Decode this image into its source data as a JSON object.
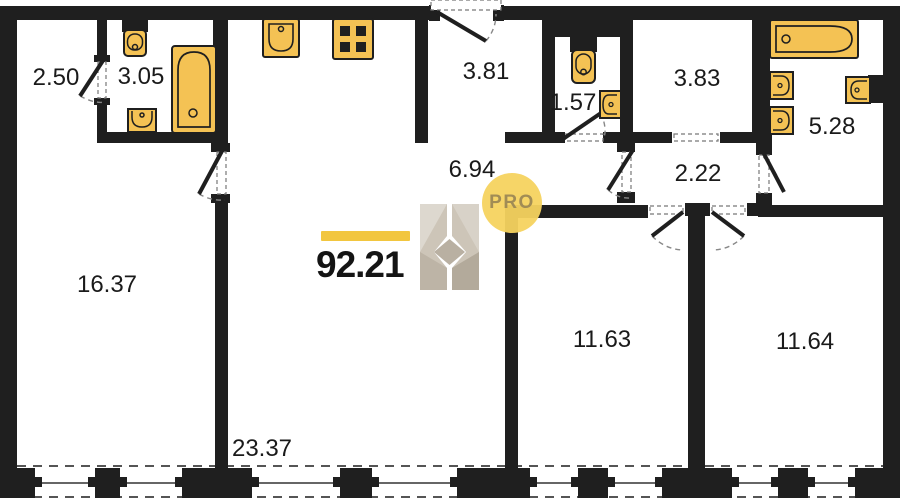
{
  "summary": {
    "total_area": "92.21"
  },
  "watermark": {
    "brand_letter": "H",
    "badge_text": "PRO"
  },
  "rooms": [
    {
      "name": "closet",
      "area": "2.50"
    },
    {
      "name": "bathroom-1",
      "area": "3.05"
    },
    {
      "name": "balcony-room",
      "area": "3.81"
    },
    {
      "name": "wc",
      "area": "1.57"
    },
    {
      "name": "pantry",
      "area": "3.83"
    },
    {
      "name": "bathroom-2",
      "area": "5.28"
    },
    {
      "name": "hallway",
      "area": "6.94"
    },
    {
      "name": "corridor",
      "area": "2.22"
    },
    {
      "name": "bedroom-1",
      "area": "16.37"
    },
    {
      "name": "bedroom-2",
      "area": "11.63"
    },
    {
      "name": "bedroom-3",
      "area": "11.64"
    },
    {
      "name": "living-kitchen",
      "area": "23.37"
    }
  ],
  "colors": {
    "wall": "#1f1f1f",
    "fixture_fill": "#f4c254",
    "accent_bar": "#f2c63f",
    "badge_fill": "#f5d35f",
    "badge_text": "#a18c55"
  }
}
